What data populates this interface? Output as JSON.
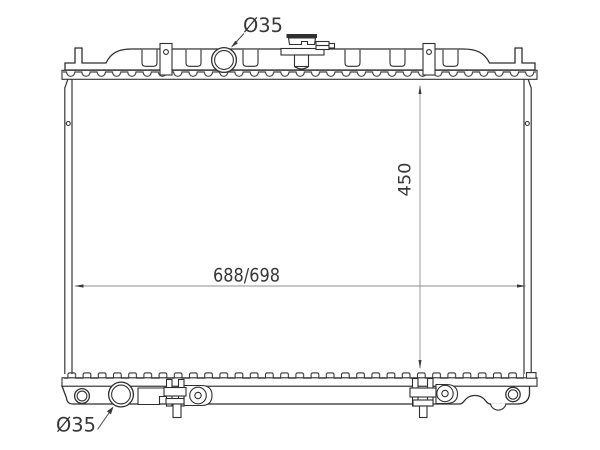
{
  "diagram": {
    "type": "technical-line-drawing",
    "subject": "automotive radiator, front view",
    "line_color": "#2f2f2f",
    "dim_line_color": "#8f8f8f",
    "background": "#ffffff",
    "labels": {
      "top_port_diameter": "Ø35",
      "bottom_port_diameter": "Ø35",
      "core_height": "450",
      "core_width": "688/698"
    },
    "values": {
      "core_height_mm": 450,
      "core_width_mm": "688/698",
      "port_diameter_mm": 35
    }
  }
}
